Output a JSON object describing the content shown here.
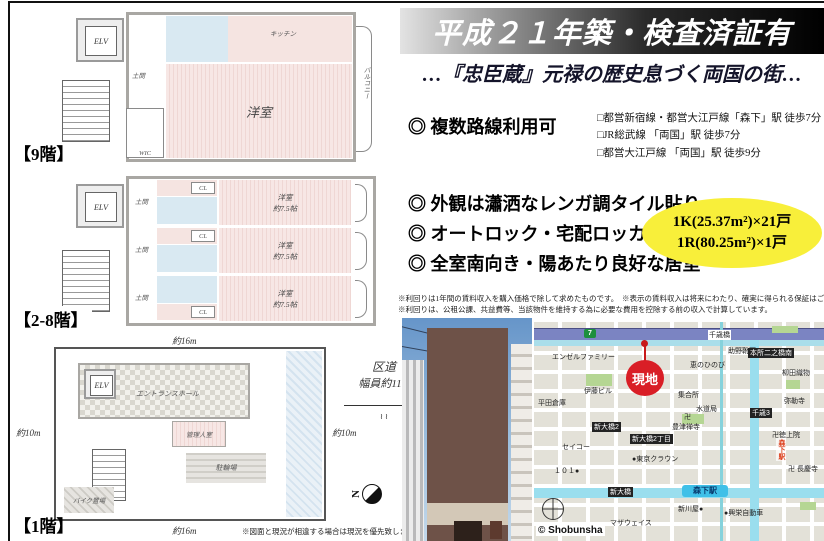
{
  "header": {
    "title": "平成２１年築・検査済証有",
    "subtitle": "…『忠臣蔵』元禄の歴史息づく両国の街…"
  },
  "features": {
    "routes": "◎ 複数路線利用可",
    "stations": [
      "□都営新宿線・都営大江戸線「森下」駅 徒歩7分",
      "□JR総武線 「両国」駅 徒歩7分",
      "□都営大江戸線 「両国」駅 徒歩9分"
    ],
    "exterior": "◎ 外観は瀟洒なレンガ調タイル貼り",
    "autolock": "◎ オートロック・宅配ロッカー有",
    "south": "◎ 全室南向き・陽あたり良好な居室"
  },
  "units": {
    "line1": "1K(25.37m²)×21戸",
    "line2": "1R(80.25m²)×1戸",
    "highlight_color": "#f8ef3a"
  },
  "disclaimer": {
    "line1": "※利回りは1年間の賃料収入を購入価格で除して求めたものです。　※表示の賃料収入は将来にわたり、確実に得られる保証はございません。",
    "line2": "※利回りは、公租公課、共益費等、当該物件を維持する為に必要な費用を控除する前の収入で計算しています。"
  },
  "floorplans": {
    "floor9": {
      "label": "【9階】",
      "elv": "ELV",
      "doma": "土間",
      "wic": "WIC",
      "room": "洋室",
      "kitchen": "キッチン",
      "balcony": "バルコニー"
    },
    "floor2_8": {
      "label": "【2-8階】",
      "elv": "ELV",
      "doma": "土間",
      "cl": "CL",
      "room_name": "洋室",
      "room_size": "約7.5帖"
    },
    "floor1": {
      "label": "【1階】",
      "elv": "ELV",
      "entrance": "エントランスホール",
      "manager": "管理人室",
      "bicycle": "駐輪場",
      "bike": "バイク置場",
      "dim_top": "約16m",
      "dim_bottom": "約16m",
      "dim_left": "約10m",
      "dim_right": "約10m",
      "road_name": "区道",
      "road_width": "幅員約11m",
      "north": "N",
      "note": "※図面と現況が相違する場合は現況を優先致します"
    }
  },
  "map": {
    "site": "現地",
    "shield": "7",
    "station_band": "森下駅",
    "station_vertical": "森下駅",
    "copyright": "© Shobunsha",
    "labels": [
      "千歳橋",
      "助野靴下●",
      "本所二之橋南",
      "恵のひのび",
      "柳田織物",
      "エンゼルファミリー",
      "伊藤ビル",
      "平田倉庫",
      "集合所",
      "水道局",
      "弥勒寺",
      "千歳3",
      "卍",
      "豊津禅寺",
      "新大橋2",
      "新大橋2丁目",
      "卍徳上院",
      "セイコー",
      "●東京クラウン",
      "１０１●",
      "卍 長慶寺",
      "新大橋",
      "新川屋●",
      "●興栄自動車",
      "マザウェイス"
    ]
  }
}
